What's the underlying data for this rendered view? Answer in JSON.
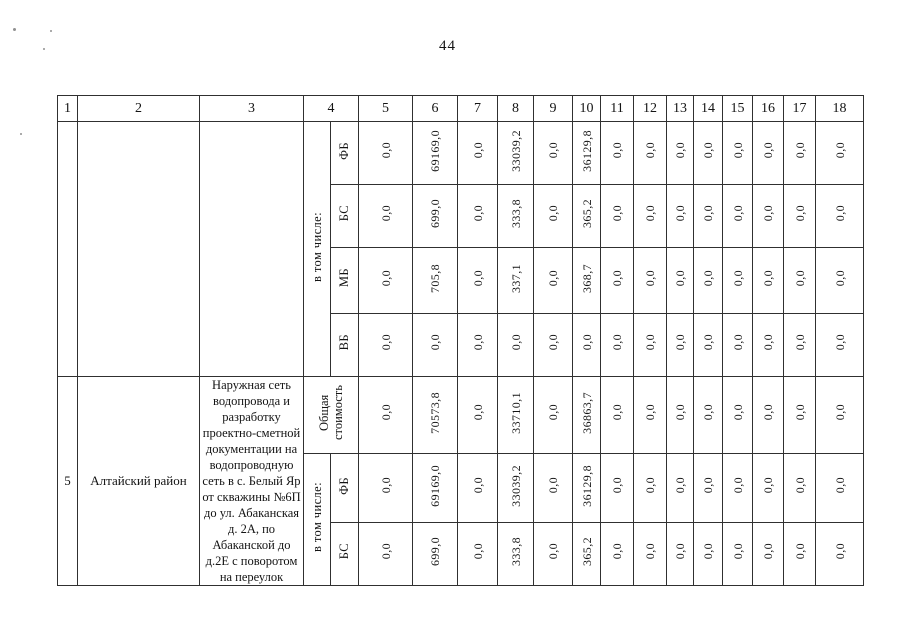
{
  "page": {
    "number": "44"
  },
  "table": {
    "header_cols": [
      "1",
      "2",
      "3",
      "4",
      "5",
      "6",
      "7",
      "8",
      "9",
      "10",
      "11",
      "12",
      "13",
      "14",
      "15",
      "16",
      "17",
      "18"
    ],
    "labels": {
      "in_total": "в том числе:"
    },
    "top_section": {
      "rows": [
        {
          "label": "ФБ",
          "values": [
            "0,0",
            "69169,0",
            "0,0",
            "33039,2",
            "0,0",
            "36129,8",
            "0,0",
            "0,0",
            "0,0",
            "0,0",
            "0,0",
            "0,0",
            "0,0",
            "0,0"
          ]
        },
        {
          "label": "БС",
          "values": [
            "0,0",
            "699,0",
            "0,0",
            "333,8",
            "0,0",
            "365,2",
            "0,0",
            "0,0",
            "0,0",
            "0,0",
            "0,0",
            "0,0",
            "0,0",
            "0,0"
          ]
        },
        {
          "label": "МБ",
          "values": [
            "0,0",
            "705,8",
            "0,0",
            "337,1",
            "0,0",
            "368,7",
            "0,0",
            "0,0",
            "0,0",
            "0,0",
            "0,0",
            "0,0",
            "0,0",
            "0,0"
          ]
        },
        {
          "label": "ВБ",
          "values": [
            "0,0",
            "0,0",
            "0,0",
            "0,0",
            "0,0",
            "0,0",
            "0,0",
            "0,0",
            "0,0",
            "0,0",
            "0,0",
            "0,0",
            "0,0",
            "0,0"
          ]
        }
      ]
    },
    "bottom_section": {
      "row_number": "5",
      "district": "Алтайский район",
      "object_description": "Наружная сеть водопровода и разработку проектно-сметной документации на водопроводную сеть в с. Белый Яр от скважины №6П до ул. Абаканская д. 2А, по Абаканской до д.2Е с поворотом на переулок",
      "total_row": {
        "label": "Общая стоимость",
        "values": [
          "0,0",
          "70573,8",
          "0,0",
          "33710,1",
          "0,0",
          "36863,7",
          "0,0",
          "0,0",
          "0,0",
          "0,0",
          "0,0",
          "0,0",
          "0,0",
          "0,0"
        ]
      },
      "rows": [
        {
          "label": "ФБ",
          "values": [
            "0,0",
            "69169,0",
            "0,0",
            "33039,2",
            "0,0",
            "36129,8",
            "0,0",
            "0,0",
            "0,0",
            "0,0",
            "0,0",
            "0,0",
            "0,0",
            "0,0"
          ]
        },
        {
          "label": "БС",
          "values": [
            "0,0",
            "699,0",
            "0,0",
            "333,8",
            "0,0",
            "365,2",
            "0,0",
            "0,0",
            "0,0",
            "0,0",
            "0,0",
            "0,0",
            "0,0",
            "0,0"
          ]
        }
      ]
    }
  }
}
